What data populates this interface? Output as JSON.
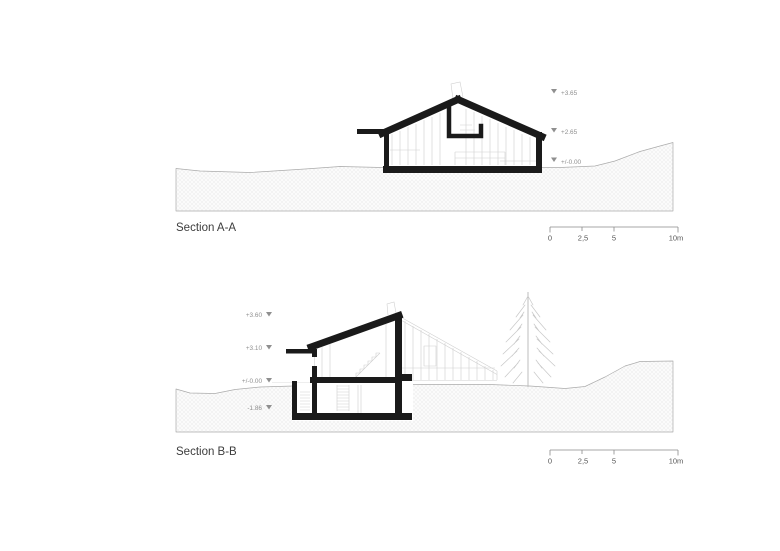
{
  "document": {
    "type": "architectural section drawings",
    "background": "#ffffff"
  },
  "colors": {
    "cut_wall": "#1a1a1a",
    "thin_line": "#cfcfcf",
    "terrain_outline": "#ababab",
    "hatch_line": "#e7e7e7",
    "hatch_bg": "#fbfbfb",
    "title": "#3d3d3d",
    "marker": "#8f8f8f",
    "scale": "#555555"
  },
  "section_a": {
    "title": "Section A-A",
    "markers": [
      {
        "label": "+3.65"
      },
      {
        "label": "+2.65"
      },
      {
        "label": "+/-0.00"
      }
    ],
    "scale_bar": {
      "labels": [
        "0",
        "2,5",
        "5",
        "10m"
      ]
    }
  },
  "section_b": {
    "title": "Section B-B",
    "markers": [
      {
        "label": "+3.60"
      },
      {
        "label": "+3.10"
      },
      {
        "label": "+/-0.00"
      },
      {
        "label": "-1.86"
      }
    ],
    "scale_bar": {
      "labels": [
        "0",
        "2,5",
        "5",
        "10m"
      ]
    }
  }
}
